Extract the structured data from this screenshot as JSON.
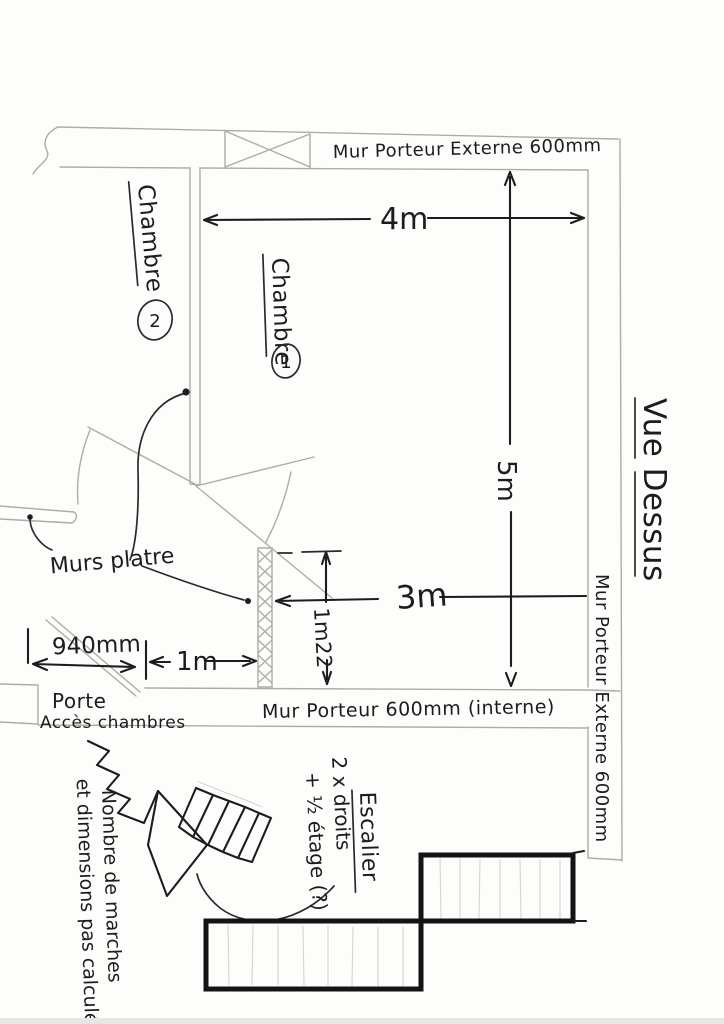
{
  "title": {
    "text": "Vue Dessus"
  },
  "walls": {
    "top_label": "Mur Porteur Externe 600mm",
    "right_label": "Mur Porteur Externe 600mm",
    "internal_label": "Mur Porteur 600mm (interne)",
    "plaster_label": "Murs platre"
  },
  "rooms": {
    "chambre1_label": "Chambre",
    "chambre1_number": "1",
    "chambre2_label": "Chambre",
    "chambre2_number": "2"
  },
  "dimensions": {
    "top_width": "4m",
    "right_height": "5m",
    "mid_width": "3m",
    "partition_height": "1m22",
    "opening_width": "1m",
    "door_width": "940mm"
  },
  "door_label": {
    "line1": "Porte",
    "line2": "Accès chambres"
  },
  "stairs": {
    "title": "Escalier",
    "note1": "2 x droits",
    "note2": "+ ½ étage (?)",
    "caption1": "Nombre de marches",
    "caption2": "et dimensions pas calculés"
  },
  "colors": {
    "ink": "#1c1c1c",
    "pencil": "#aeaca8",
    "paper": "#fdfdfc",
    "heavy": "#141414"
  }
}
